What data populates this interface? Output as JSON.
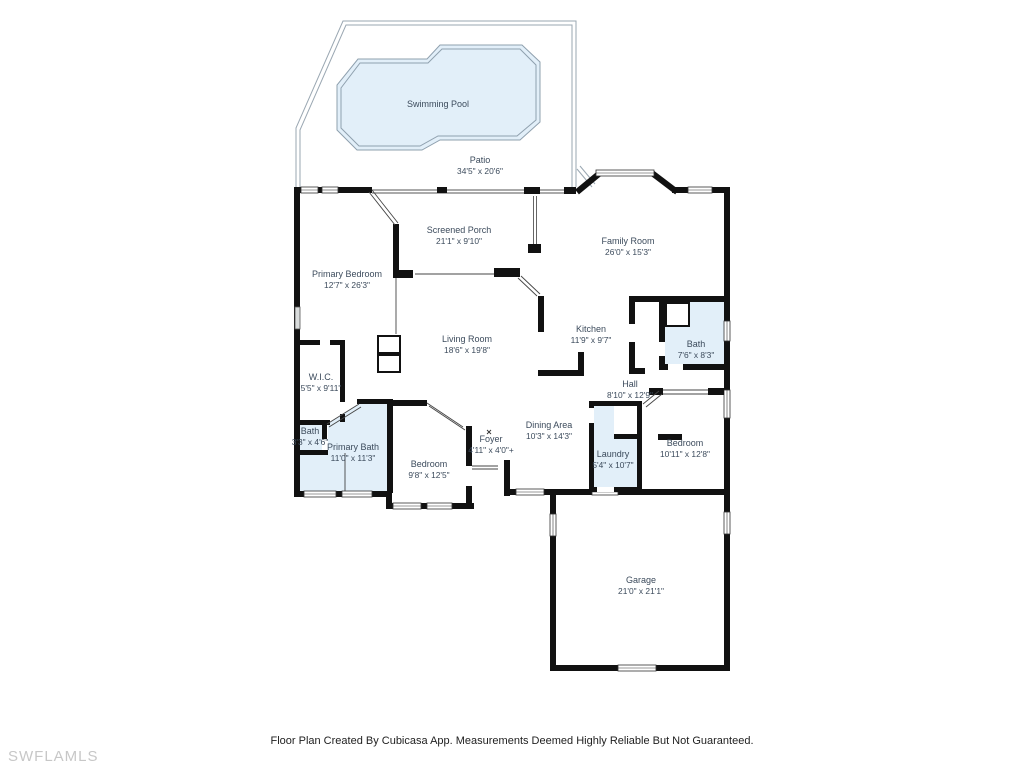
{
  "meta": {
    "watermark": "SWFLAMLS",
    "footer": "Floor Plan Created By Cubicasa App. Measurements Deemed Highly Reliable But Not Guaranteed."
  },
  "colors": {
    "wall": "#111111",
    "water_fill": "#e2eff9",
    "pool_outline": "#9aa7b2",
    "label_text": "#3c4b5c",
    "footer_text": "#1e1e1e",
    "watermark_text": "#c7c7c7",
    "background": "#ffffff"
  },
  "rooms": [
    {
      "id": "swimming-pool",
      "name": "Swimming Pool",
      "dims": "",
      "x": 438,
      "y": 107
    },
    {
      "id": "patio",
      "name": "Patio",
      "dims": "34'5\" x 20'6\"",
      "x": 480,
      "y": 163
    },
    {
      "id": "screened-porch",
      "name": "Screened Porch",
      "dims": "21'1\" x 9'10\"",
      "x": 459,
      "y": 233
    },
    {
      "id": "family-room",
      "name": "Family Room",
      "dims": "26'0\" x 15'3\"",
      "x": 628,
      "y": 244
    },
    {
      "id": "primary-bedroom",
      "name": "Primary Bedroom",
      "dims": "12'7\" x 26'3\"",
      "x": 347,
      "y": 277
    },
    {
      "id": "living-room",
      "name": "Living Room",
      "dims": "18'6\" x 19'8\"",
      "x": 467,
      "y": 342
    },
    {
      "id": "kitchen",
      "name": "Kitchen",
      "dims": "11'9\" x 9'7\"",
      "x": 591,
      "y": 332
    },
    {
      "id": "bath-2",
      "name": "Bath",
      "dims": "7'6\" x 8'3\"",
      "x": 696,
      "y": 347
    },
    {
      "id": "wic",
      "name": "W.I.C.",
      "dims": "5'5\" x 9'11\"",
      "x": 321,
      "y": 380
    },
    {
      "id": "hall",
      "name": "Hall",
      "dims": "8'10\" x 12'9\"",
      "x": 630,
      "y": 387
    },
    {
      "id": "dining-area",
      "name": "Dining Area",
      "dims": "10'3\" x 14'3\"",
      "x": 549,
      "y": 428
    },
    {
      "id": "foyer",
      "name": "Foyer",
      "dims": "4'11\" x 4'0\"+",
      "x": 491,
      "y": 442
    },
    {
      "id": "bath-1",
      "name": "Bath",
      "dims": "3'3\" x 4'6\"",
      "x": 310,
      "y": 434
    },
    {
      "id": "primary-bath",
      "name": "Primary Bath",
      "dims": "11'0\" x 11'3\"",
      "x": 353,
      "y": 450
    },
    {
      "id": "bedroom-1",
      "name": "Bedroom",
      "dims": "9'8\" x 12'5\"",
      "x": 429,
      "y": 467
    },
    {
      "id": "laundry",
      "name": "Laundry",
      "dims": "5'4\" x 10'7\"",
      "x": 613,
      "y": 457
    },
    {
      "id": "bedroom-2",
      "name": "Bedroom",
      "dims": "10'11\" x 12'8\"",
      "x": 685,
      "y": 446
    },
    {
      "id": "garage",
      "name": "Garage",
      "dims": "21'0\" x 21'1\"",
      "x": 641,
      "y": 583
    }
  ]
}
